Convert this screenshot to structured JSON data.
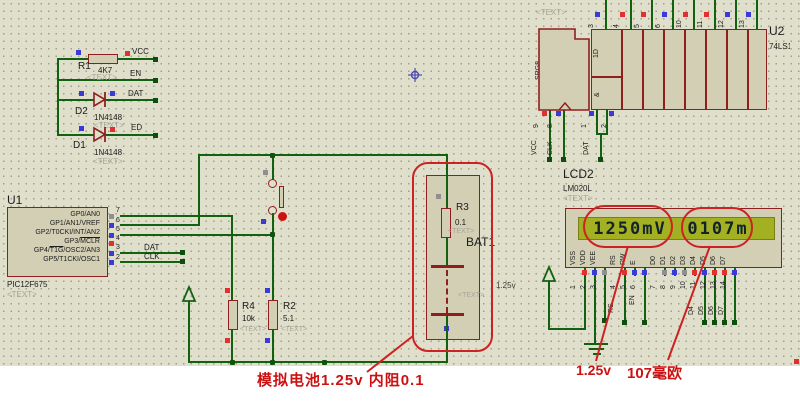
{
  "colors": {
    "wire": "#116111",
    "component_border": "#8f1f1f",
    "component_fill": "#d2cfb5",
    "annotation_red": "#cc2222",
    "lcd_screen": "#a2b021",
    "lcd_text": "#14222b",
    "select_blue": "#3a3ad6",
    "select_red": "#e03030",
    "select_gray": "#8f8f8f",
    "canvas": "#e0dfcc"
  },
  "left_section": {
    "r1": {
      "ref": "R1",
      "value": "4K7",
      "placeholder": "<TEXT>"
    },
    "net_labels": {
      "vcc": "VCC",
      "en": "EN",
      "dat": "DAT",
      "ed": "ED"
    },
    "d2": {
      "ref": "D2",
      "value": "1N4148",
      "placeholder": "<TEXT>"
    },
    "d1": {
      "ref": "D1",
      "value": "1N4148",
      "placeholder": "<TEXT>"
    }
  },
  "u1": {
    "ref": "U1",
    "part": "PIC12F675",
    "placeholder": "<TEXT>",
    "pins": [
      {
        "num": "7",
        "label": "GP0/AN0"
      },
      {
        "num": "6",
        "label": "GP1/AN1/VREF"
      },
      {
        "num": "5",
        "label": "GP2/T0CKI/INT/AN2"
      },
      {
        "num": "4",
        "label_pre": "GP3/",
        "label_ov": "MCLR"
      },
      {
        "num": "3",
        "label_pre": "GP4/",
        "label_ov": "T1G",
        "label_post": "/OSC2/AN3"
      },
      {
        "num": "2",
        "label": "GP5/T1CKI/OSC1"
      }
    ],
    "net_labels": {
      "dat": "DAT",
      "clk": "CLK"
    }
  },
  "resistors": {
    "r4": {
      "ref": "R4",
      "value": "10k",
      "placeholder": "<TEXT>"
    },
    "r2": {
      "ref": "R2",
      "value": "5.1",
      "placeholder": "<TEXT>"
    }
  },
  "battery": {
    "ref": "BAT1",
    "placeholder": "<TEXT>",
    "voltage": "1.25v",
    "r3": {
      "ref": "R3",
      "value": "0.1",
      "placeholder": "<TEXT>"
    }
  },
  "u2": {
    "ref": "U2",
    "part": "74LS164",
    "placeholder": "<TEXT>",
    "symbol": {
      "srg": "SRG8",
      "reset": "R",
      "clock": "C1/->",
      "data": "1D",
      "and": "&"
    },
    "top_pin_nums": [
      "3",
      "4",
      "5",
      "6",
      "10",
      "11",
      "12",
      "13"
    ],
    "bottom_pin_nums": [
      "9",
      "8",
      "1",
      "2"
    ],
    "net_labels": {
      "vcc": "VCC",
      "clk": "CLK",
      "dat": "DAT"
    }
  },
  "lcd": {
    "ref": "LCD2",
    "part": "LM020L",
    "placeholder": "<TEXT>",
    "display_left": "1250mV",
    "display_right": "0107m",
    "pin_labels": [
      "VSS",
      "VDD",
      "VEE",
      "RS",
      "RW",
      "E",
      "D0",
      "D1",
      "D2",
      "D3",
      "D4",
      "D5",
      "D6",
      "D7"
    ],
    "pin_nums": [
      "1",
      "2",
      "3",
      "4",
      "5",
      "6",
      "7",
      "8",
      "9",
      "10",
      "11",
      "12",
      "13",
      "14"
    ],
    "net_labels": [
      "RS",
      "EN",
      "D4",
      "D5",
      "D6",
      "D7"
    ]
  },
  "annotations": {
    "battery_note": "模拟电池1.25v  内阻0.1",
    "voltage_note": "1.25v",
    "resistance_note": "107毫欧"
  }
}
